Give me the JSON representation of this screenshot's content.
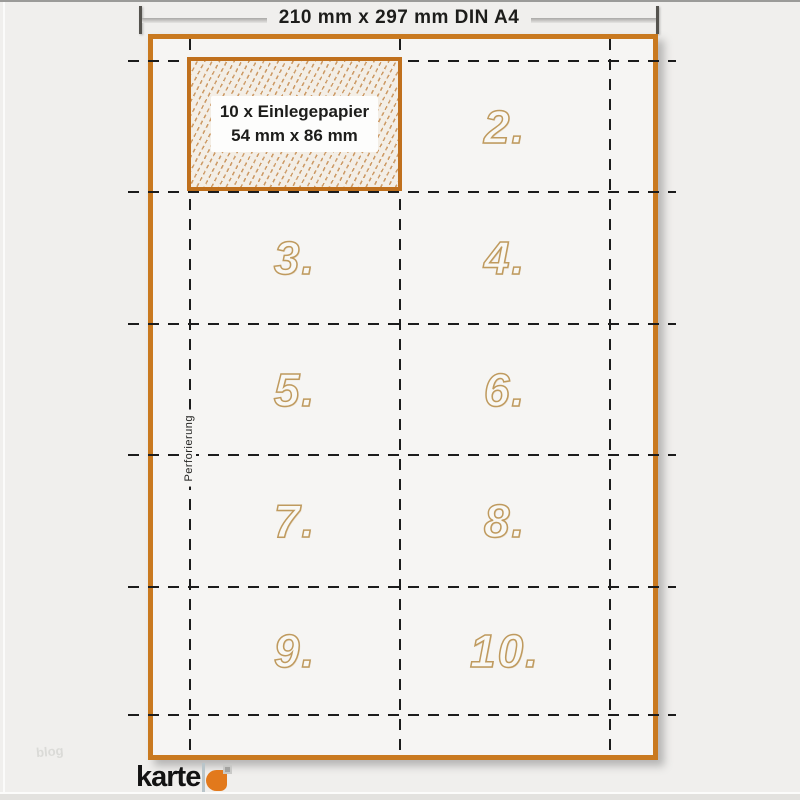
{
  "dimension_line": {
    "label": "210 mm x 297 mm DIN A4"
  },
  "sheet": {
    "insert_area": {
      "label_line1": "10 x Einlegepapier",
      "label_line2": "54 mm x 86 mm"
    },
    "perforation_label": "Perforierung",
    "cell_numbers": [
      "2.",
      "3.",
      "4.",
      "5.",
      "6.",
      "7.",
      "8.",
      "9.",
      "10."
    ]
  },
  "watermark": "blog",
  "footer": {
    "logo_text": "karte"
  },
  "colors": {
    "background": "#f0efed",
    "sheet_fill": "#f6f5f3",
    "sheet_border_orange": "#c9791f",
    "insert_border_orange": "#c0701d",
    "hatch_orange": "#b96f23",
    "number_outline_tan": "#bf9a5e",
    "dash_black": "#1c1c1c",
    "logo_orange": "#e2791c",
    "logo_bar_gray": "#b9c5ca"
  }
}
